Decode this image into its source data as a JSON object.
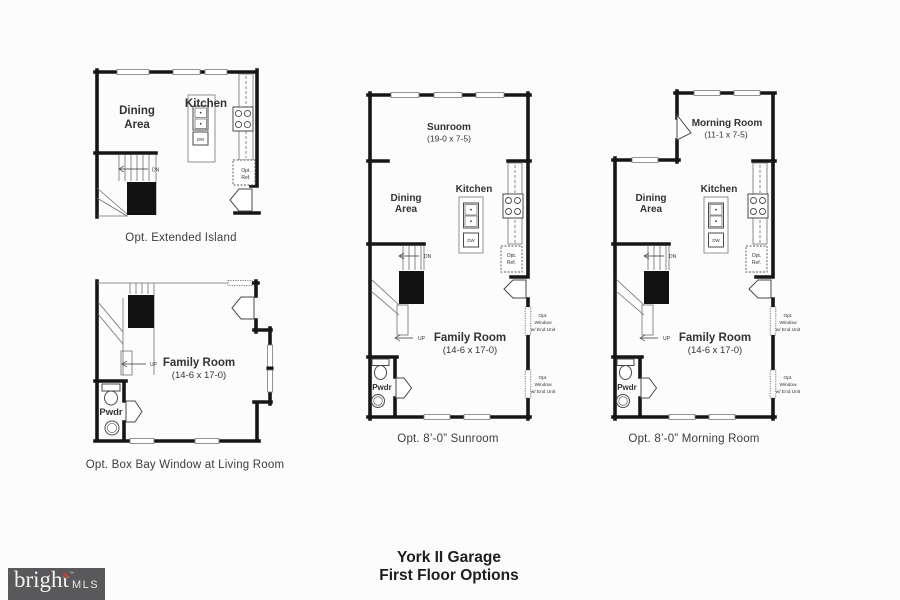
{
  "title": {
    "line1": "York II Garage",
    "line2": "First Floor Options"
  },
  "logo": {
    "brand": "bright",
    "tm": "™",
    "suffix": "MLS"
  },
  "captions": {
    "plan1": "Opt. Extended Island",
    "plan2": "Opt. Box Bay Window at Living Room",
    "plan3": "Opt. 8’-0” Sunroom",
    "plan4": "Opt. 8’-0” Morning Room"
  },
  "labels": {
    "dining1": "Dining",
    "dining2": "Area",
    "kitchen": "Kitchen",
    "dw": "DW",
    "optref1": "Opt.",
    "optref2": "Ref.",
    "dn": "DN",
    "up": "UP",
    "family": "Family Room",
    "family_dim": "(14-6 x 17-0)",
    "pwdr": "Pwdr",
    "sunroom": "Sunroom",
    "sunroom_dim": "(19-0 x 7-5)",
    "morning": "Morning Room",
    "morning_dim": "(11-1 x 7-5)",
    "optwin1": "Opt.",
    "optwin2": "Window",
    "optwin3": "w/ End Unit"
  }
}
